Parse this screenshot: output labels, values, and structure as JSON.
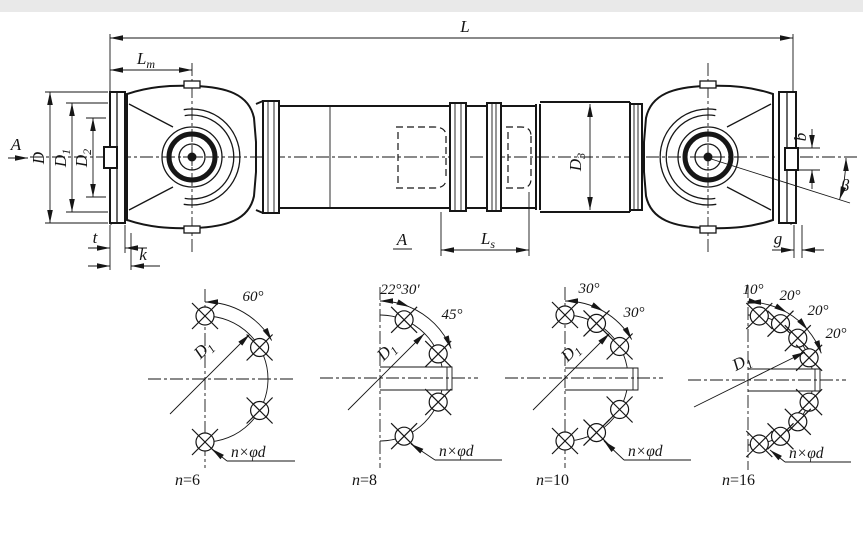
{
  "main_view": {
    "dims": {
      "overall_length": "L",
      "Lm": {
        "base": "L",
        "sub": "m"
      },
      "D": "D",
      "D1": {
        "base": "D",
        "sub": "1"
      },
      "D2": {
        "base": "D",
        "sub": "2"
      },
      "D3": {
        "base": "D",
        "sub": "3"
      },
      "Ls": {
        "base": "L",
        "sub": "s"
      },
      "b": "b",
      "beta": "β",
      "t": "t",
      "k": "k",
      "g": "g"
    },
    "section_arrow_label": "A",
    "section_view_label": "A"
  },
  "flange_views": [
    {
      "caption_var": "n",
      "caption_rest": "=6",
      "angles": [
        "60°"
      ],
      "d_label": {
        "base": "D",
        "sub": "1"
      },
      "holes_note": "n×φd"
    },
    {
      "caption_var": "n",
      "caption_rest": "=8",
      "angles": [
        "22°30′",
        "45°"
      ],
      "d_label": {
        "base": "D",
        "sub": "1"
      },
      "holes_note": "n×φd"
    },
    {
      "caption_var": "n",
      "caption_rest": "=10",
      "angles": [
        "30°",
        "30°"
      ],
      "d_label": {
        "base": "D",
        "sub": "1"
      },
      "holes_note": "n×φd"
    },
    {
      "caption_var": "n",
      "caption_rest": "=16",
      "angles": [
        "10°",
        "20°",
        "20°",
        "20°"
      ],
      "d_label": {
        "base": "D",
        "sub": "1"
      },
      "holes_note": "n×φd"
    }
  ]
}
